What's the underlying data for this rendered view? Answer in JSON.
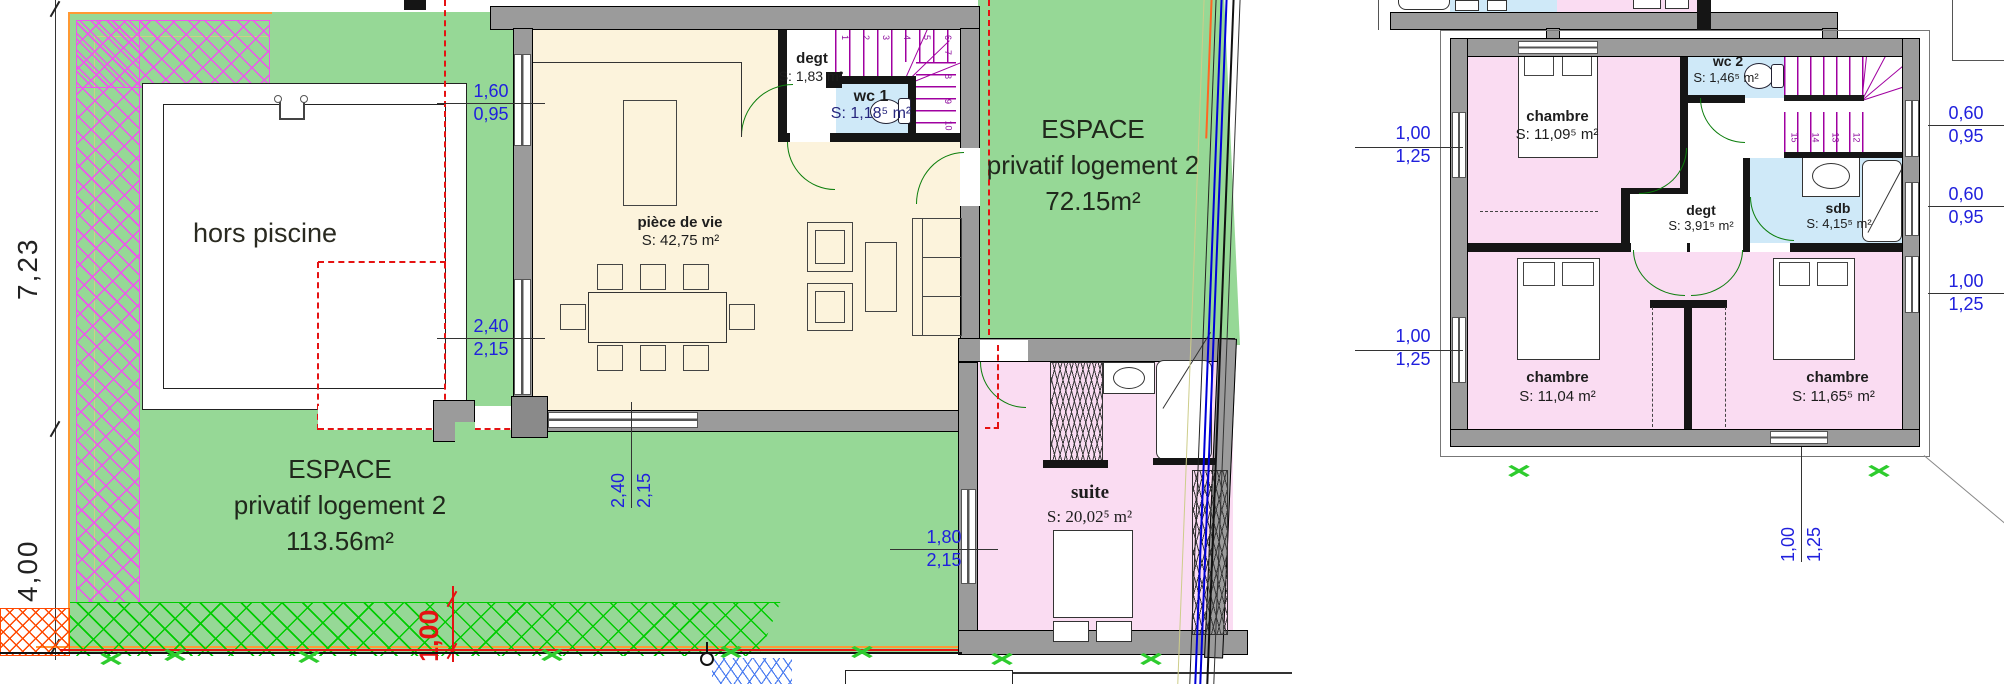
{
  "colors": {
    "garden": "#96d896",
    "room": "#fcf3dc",
    "pink": "#fadcf2",
    "blue": "#cfe9f8",
    "wall": "#9b9b9b",
    "dim": "#2020dd",
    "red": "#e51212",
    "stair": "#a000a0",
    "door": "#0a7d0a",
    "hatchpink": "#ee55ee",
    "hatchgreen": "#00cc00",
    "boundary": "#0000d8",
    "orange": "#ff9933"
  },
  "ground_floor": {
    "pool": {
      "label": "hors piscine"
    },
    "garden_sw": {
      "lines": [
        "ESPACE",
        "privatif logement 2",
        "113.56m²"
      ]
    },
    "garden_e": {
      "lines": [
        "ESPACE",
        "privatif logement 2",
        "72.15m²"
      ]
    },
    "rooms": {
      "living": {
        "name": "pièce de vie",
        "area": "S: 42,75 m²"
      },
      "degt": {
        "name": "degt",
        "area": "S: 1,83 m²"
      },
      "wc1": {
        "name": "wc 1",
        "area": "S: 1,18⁵ m²"
      },
      "suite": {
        "name": "suite",
        "area": "S: 20,02⁵ m²"
      }
    },
    "stairs": {
      "top_numbers": [
        "1",
        "2",
        "3",
        "4",
        "5",
        "6"
      ],
      "side_numbers": [
        "7",
        "8",
        "9",
        "10"
      ]
    }
  },
  "upper_floor": {
    "rooms": {
      "chambre_nw": {
        "name": "chambre",
        "area": "S: 11,09⁵ m²"
      },
      "wc2": {
        "name": "wc 2",
        "area": "S: 1,46⁵ m²"
      },
      "degt": {
        "name": "degt",
        "area": "S: 3,91⁵ m²"
      },
      "sdb": {
        "name": "sdb",
        "area": "S: 4,15⁵ m²"
      },
      "chambre_sw": {
        "name": "chambre",
        "area": "S: 11,04 m²"
      },
      "chambre_se": {
        "name": "chambre",
        "area": "S: 11,65⁵ m²"
      }
    },
    "stairs": {
      "top_numbers": [
        "1",
        "2",
        "3",
        "4",
        "5",
        "6",
        "7"
      ],
      "bottom_numbers": [
        "15",
        "14",
        "13",
        "12"
      ]
    }
  },
  "dimensions": {
    "site_upper": "7,23",
    "site_lower": "4,00",
    "band_red": "1,00",
    "d_window_nw": {
      "top": "1,60",
      "bottom": "0,95"
    },
    "d_window_w": {
      "top": "2,40",
      "bottom": "2,15"
    },
    "d_door_s": {
      "top": "2,40",
      "bottom": "2,15"
    },
    "d_suite": {
      "top": "1,80",
      "bottom": "2,15"
    },
    "d_up_w1": {
      "top": "1,00",
      "bottom": "1,25"
    },
    "d_up_w2": {
      "top": "1,00",
      "bottom": "1,25"
    },
    "d_up_e1": {
      "top": "0,60",
      "bottom": "0,95"
    },
    "d_up_e2": {
      "top": "0,60",
      "bottom": "0,95"
    },
    "d_up_e3": {
      "top": "1,00",
      "bottom": "1,25"
    },
    "d_up_s": {
      "top": "1,00",
      "bottom": "1,25"
    }
  }
}
